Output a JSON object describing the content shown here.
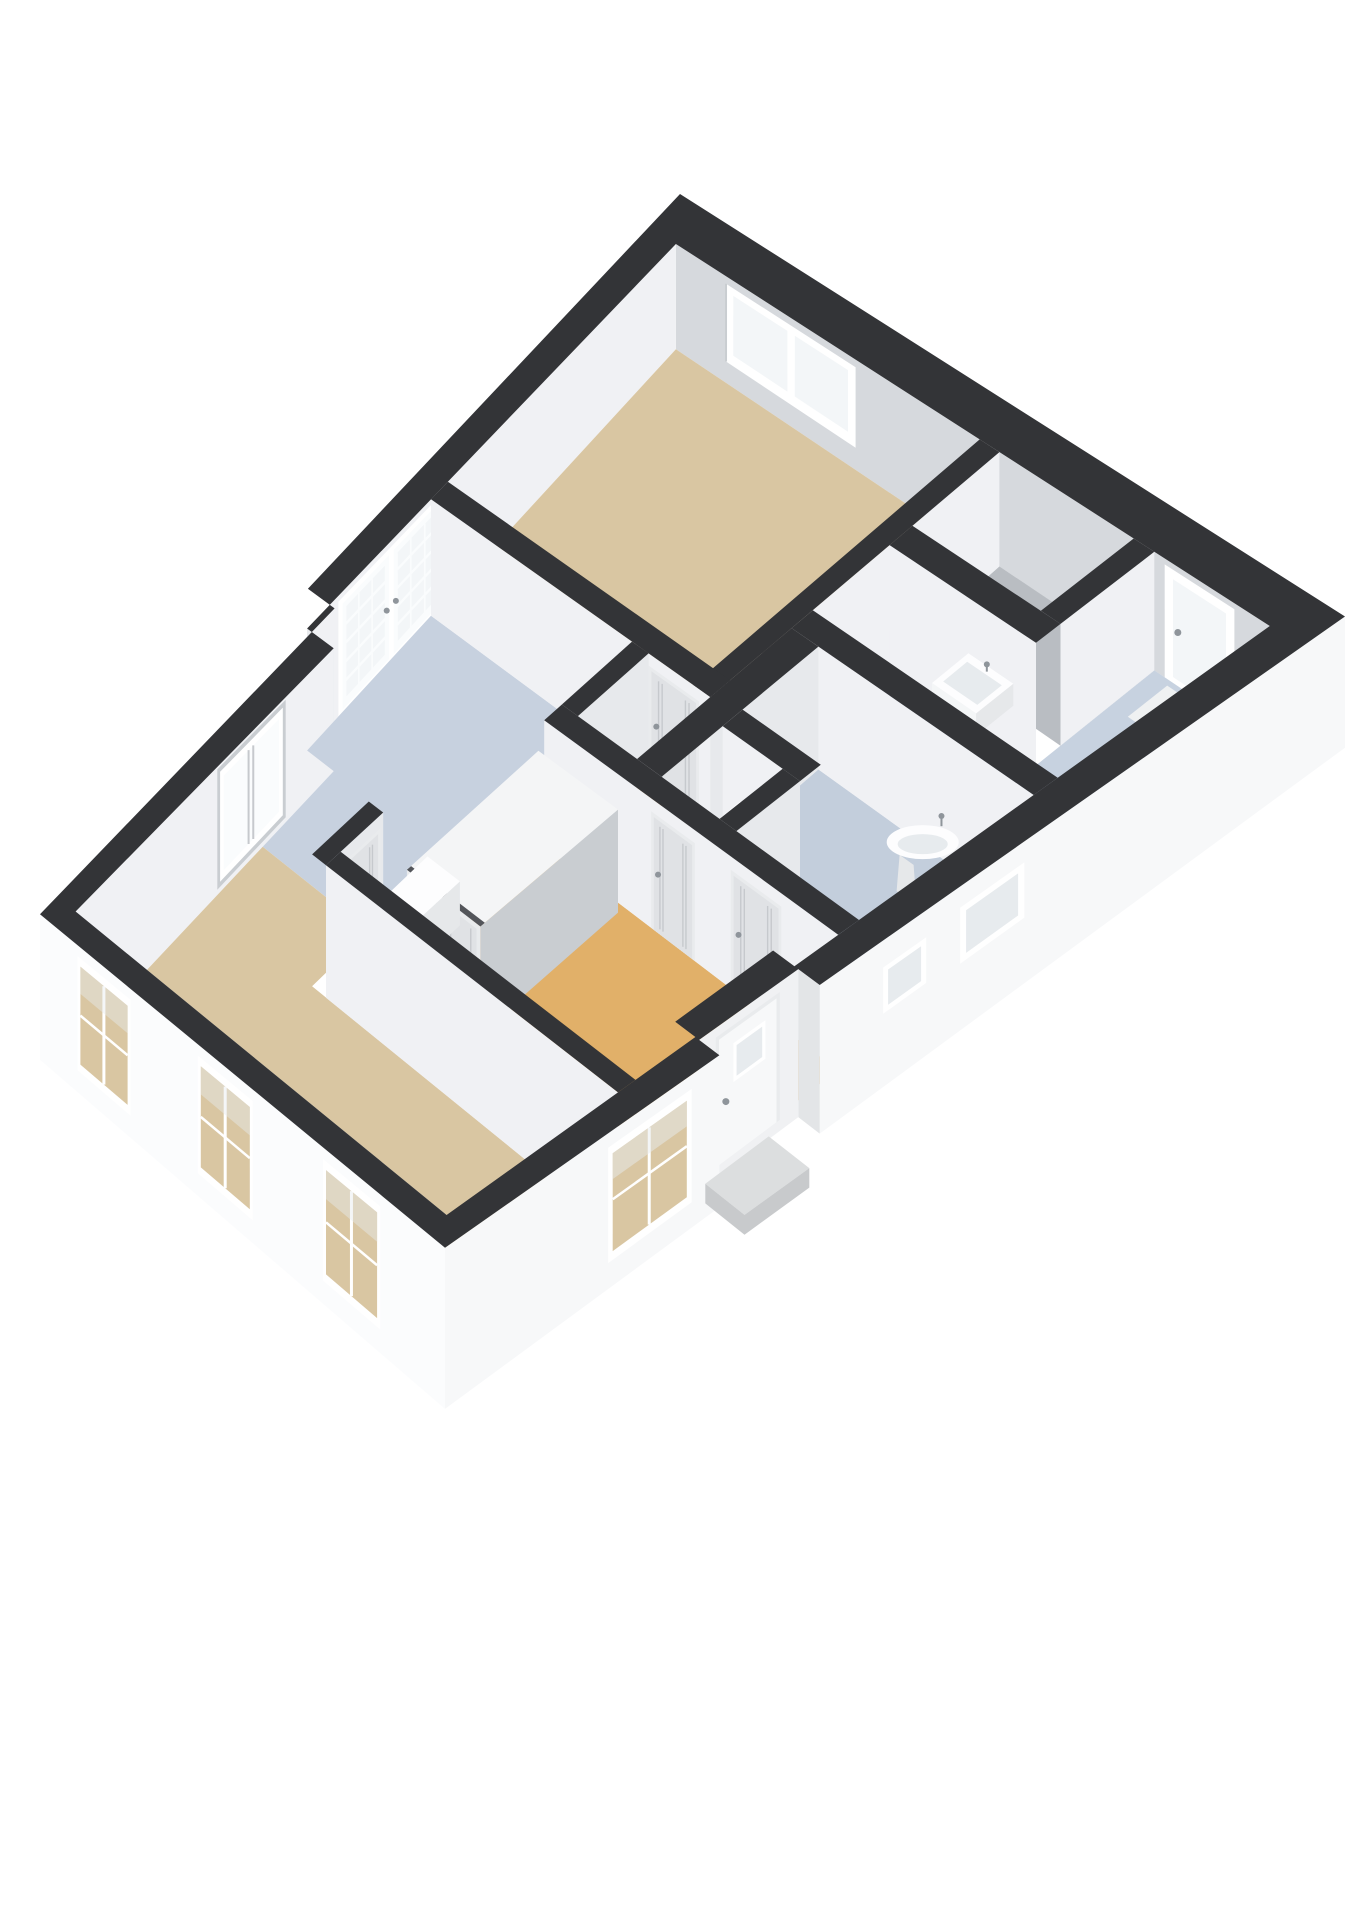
{
  "scene": {
    "kind": "isometric-3d-floorplan-render",
    "background": "#ffffff",
    "view": "birds-eye, plan rotated ~34deg, dark cut wall caps"
  },
  "palette": {
    "wall_cap": "#333437",
    "facade_white": "#f7f8f9",
    "facade_bright": "#fbfcfd",
    "facade_shade": "#e3e5e7",
    "facade_recess": "#f0f1f3",
    "inner_wall_light": "#f0f1f4",
    "inner_wall_mid": "#e7e9ec",
    "inner_wall_gray": "#d6d9dd",
    "inner_wall_dark": "#c9cdd1",
    "floor_living": "#d9c6a2",
    "floor_bedroom": "#d9c6a2",
    "floor_hall": "#e1b069",
    "floor_kitchen": "#c7d1df",
    "floor_bath": "#c3cedc",
    "floor_utility": "#c7d2e0",
    "floor_closet": "#b9bdc2",
    "glass": "#f3f6f8",
    "glass_bright": "#fafcfd",
    "glass_cool": "#e7ebee",
    "frame_white": "#ffffff",
    "door_leaf": "#e0e2e5",
    "door_frame": "#e9ebed",
    "door_groove": "#c6c9cd",
    "fixture_white": "#fdfdfe",
    "fixture_shade": "#e6e8ea",
    "fixture_front": "#f4f6f7",
    "metal": "#8f959b",
    "step_top": "#dcdedf",
    "step_front": "#c8cacc",
    "shadow_edge": "#53555a",
    "mat_white": "#eff1f2",
    "closet_top": "#f4f5f6"
  },
  "rooms": [
    {
      "id": "bedroom",
      "label": "bedroom",
      "floor": "floor_bedroom"
    },
    {
      "id": "utility-room",
      "label": "utility room",
      "floor": "floor_utility"
    },
    {
      "id": "bathroom",
      "label": "bathroom",
      "floor": "floor_bath"
    },
    {
      "id": "wc",
      "label": "toilet",
      "floor": "floor_bath"
    },
    {
      "id": "kitchen",
      "label": "kitchen",
      "floor": "floor_kitchen"
    },
    {
      "id": "hallway",
      "label": "hallway",
      "floor": "floor_hall"
    },
    {
      "id": "hallway-north",
      "label": "hall corridor",
      "floor": "floor_hall"
    },
    {
      "id": "living-room",
      "label": "living room",
      "floor": "floor_living"
    },
    {
      "id": "closet-nook",
      "label": "storage nook",
      "floor": "floor_closet"
    }
  ],
  "openings": [
    {
      "id": "french-doors",
      "wall": "nw",
      "type": "glazed double doors, 15-pane grid per leaf"
    },
    {
      "id": "bedroom-window",
      "wall": "ne",
      "type": "double casement window"
    },
    {
      "id": "back-door",
      "wall": "ne",
      "type": "full glass door with handle"
    },
    {
      "id": "nw-window",
      "wall": "nw",
      "type": "tall window"
    },
    {
      "id": "se-window-1",
      "wall": "se",
      "type": "small high window"
    },
    {
      "id": "se-window-2",
      "wall": "se",
      "type": "small high window"
    },
    {
      "id": "front-door",
      "wall": "se",
      "type": "entrance door with small window, recessed"
    },
    {
      "id": "se-living-window",
      "wall": "se",
      "type": "tall window"
    },
    {
      "id": "sw-window-1",
      "wall": "sw",
      "type": "tall window"
    },
    {
      "id": "sw-window-2",
      "wall": "sw",
      "type": "tall window"
    },
    {
      "id": "sw-window-3",
      "wall": "sw",
      "type": "tall window"
    },
    {
      "id": "bedroom-door",
      "wall": "interior",
      "type": "panel door"
    },
    {
      "id": "wc-door",
      "wall": "interior",
      "type": "panel door"
    },
    {
      "id": "bathroom-door",
      "wall": "interior",
      "type": "panel door"
    },
    {
      "id": "living-room-door",
      "wall": "interior",
      "type": "panel door"
    }
  ],
  "fixtures": [
    {
      "id": "utility-wall-sink",
      "label": "wall-hung rectangular sink with faucet"
    },
    {
      "id": "pedestal-sink",
      "label": "pedestal wash basin with faucet"
    },
    {
      "id": "wc-hand-basin",
      "label": "small hand basin"
    },
    {
      "id": "kitchen-counter",
      "label": "kitchen unit block"
    },
    {
      "id": "hall-wardrobe",
      "label": "built-in wardrobe with double panel doors"
    },
    {
      "id": "entrance-step",
      "label": "concrete entrance step"
    },
    {
      "id": "back-door-mat",
      "label": "door mat"
    },
    {
      "id": "front-door-mat",
      "label": "door mat"
    }
  ]
}
